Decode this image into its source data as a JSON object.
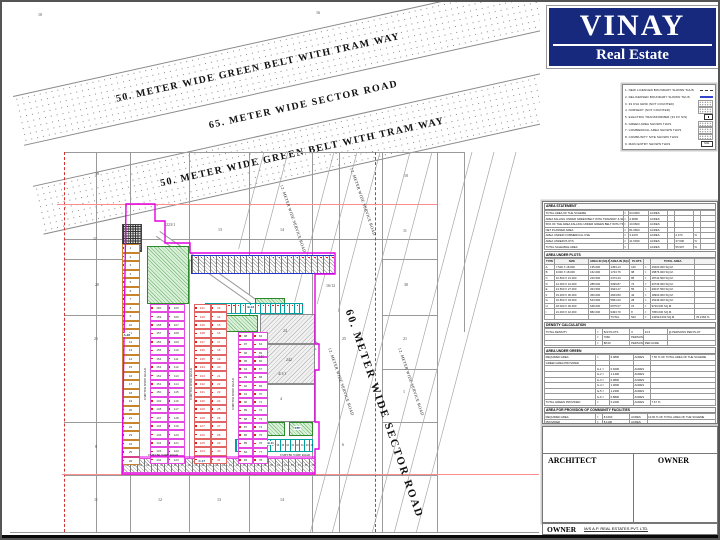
{
  "logo": {
    "title": "VINAY",
    "subtitle": "Real Estate",
    "bg": "#16297c"
  },
  "legend": {
    "items": [
      {
        "n": "1.",
        "label": "NEW LICENCED BOUNDARY SHOWN THUS",
        "sym": "dashdot"
      },
      {
        "n": "2.",
        "label": "DELICENSED BOUNDARY SHOWN THUS",
        "sym": "blue"
      },
      {
        "n": "3.",
        "label": "33 KVA GRID (NOT COUNTED)",
        "sym": "dots"
      },
      {
        "n": "4.",
        "label": "NURSERY (NOT COUNTED)",
        "sym": "dots"
      },
      {
        "n": "5.",
        "label": "ELECTRIC TRANSFORMER (33 KV S/S)",
        "sym": "box"
      },
      {
        "n": "6.",
        "label": "GREEN AREA SHOWN THUS",
        "sym": "dots"
      },
      {
        "n": "7.",
        "label": "COMMERCIAL AREA SHOWN THUS",
        "sym": "dots"
      },
      {
        "n": "8.",
        "label": "COMMUNITY SITE SHOWN THUS",
        "sym": "dots"
      },
      {
        "n": "9.",
        "label": "MAIN ENTRY SHOWN THUS",
        "sym": "me",
        "sym_text": "M.E."
      }
    ]
  },
  "tables": [
    {
      "title": "AREA STATEMENT",
      "widths": [
        46,
        3,
        12,
        11,
        4,
        11,
        4,
        9
      ],
      "rows": [
        [
          "TOTAL AREA OF THE SCHEME",
          "=",
          "94.0000",
          "ACRES",
          "",
          "",
          "",
          ""
        ],
        [
          "AREA FALLING UNDER GREEN BELT WITH TRAMWAY & SECTOR ROAD",
          "=",
          "4.3800",
          "ACRES",
          "",
          "",
          "",
          ""
        ],
        [
          "50% OF THE AREA FALLING UNDER GREEN BELT WITH TRAM WAY",
          "=",
          "10.0600",
          "ACRES",
          "",
          "",
          "",
          ""
        ],
        [
          "NET PLANNED AREA",
          "=",
          "81.0600",
          "ACRES",
          "",
          "",
          "",
          ""
        ],
        [
          "AREA UNDER COMMERCIAL USE",
          "=",
          "3.2470",
          "ACRES",
          "",
          "2.470",
          "%",
          ""
        ],
        [
          "AREA UNDER PLOTS",
          "=",
          "41.5030",
          "ACRES",
          "",
          "37.600",
          "%",
          ""
        ],
        [
          "TOTAL SALEABLE AREA",
          "=",
          "",
          "ACRES",
          "",
          "55.907",
          "%",
          ""
        ]
      ]
    },
    {
      "title": "AREA UNDER PLOTS",
      "headers": [
        "TYPE",
        "SIZE",
        "AREA IN (SQ.M.)",
        "AREA IN (SQ.FT.)",
        "PLOTS",
        "",
        "TOTAL AREA",
        ""
      ],
      "widths": [
        6,
        20,
        12,
        12,
        8,
        4,
        26,
        12
      ],
      "rows": [
        [
          "A",
          "7.500 X 18.000",
          "135.000",
          "1453.14",
          "120",
          "=",
          "16200.000  SQ.M.",
          ""
        ],
        [
          "B",
          "9.000 X 18.000",
          "162.000",
          "1743.76",
          "98",
          "=",
          "15876.000  SQ.M.",
          ""
        ],
        [
          "C",
          "10.500 X 21.000",
          "220.500",
          "2373.43",
          "85",
          "=",
          "18742.500  SQ.M.",
          ""
        ],
        [
          "D",
          "12.000 X 24.000",
          "288.000",
          "3099.87",
          "72",
          "=",
          "20736.000  SQ.M.",
          ""
        ],
        [
          "E",
          "13.500 X 27.000",
          "364.500",
          "3923.27",
          "55",
          "=",
          "20047.500  SQ.M.",
          ""
        ],
        [
          "F",
          "15.000 X 30.000",
          "450.000",
          "4843.80",
          "42",
          "=",
          "18900.000  SQ.M.",
          ""
        ],
        [
          "G",
          "16.500 X 33.000",
          "544.500",
          "5861.00",
          "28",
          "=",
          "15246.000  SQ.M.",
          ""
        ],
        [
          "H",
          "18.000 X 36.000",
          "648.000",
          "6975.07",
          "15",
          "=",
          "9720.000  SQ.M.",
          ""
        ],
        [
          "I",
          "21.000 X 42.000",
          "882.000",
          "9493.70",
          "8",
          "=",
          "7056.000  SQ.M.",
          ""
        ],
        [
          "",
          "",
          "",
          "TOTAL",
          "523",
          "=",
          "142524.000  SQ.M.",
          "35.2184 %"
        ]
      ]
    },
    {
      "title": "DENSITY CALCULATION",
      "widths": [
        30,
        4,
        16,
        8,
        14,
        28
      ],
      "rows": [
        [
          "TOTAL DENSITY",
          "=",
          "523 PLOTS",
          "X",
          "13.5",
          "@ PERSONS PER PLOT"
        ],
        [
          "",
          "=",
          "7060",
          "PERSONS",
          "",
          ""
        ],
        [
          "",
          "=",
          "88.00",
          "PERSONS",
          "PER ACRE",
          ""
        ]
      ]
    },
    {
      "title": "AREA UNDER GREEN",
      "widths": [
        30,
        8,
        14,
        10,
        38
      ],
      "rows": [
        [
          "REQUIRED AREA",
          "=",
          "6.0800",
          "ACRES",
          "7.50 % OF TOTAL AREA OF THE SCHEME"
        ],
        [
          "GREEN AREA PROVIDED",
          "",
          "",
          "",
          ""
        ],
        [
          "",
          "G-1  =",
          "0.9200",
          "ACRES",
          ""
        ],
        [
          "",
          "G-2  =",
          "1.1400",
          "ACRES",
          ""
        ],
        [
          "",
          "G-3  =",
          "0.9800",
          "ACRES",
          ""
        ],
        [
          "",
          "G-4  =",
          "1.0600",
          "ACRES",
          ""
        ],
        [
          "",
          "G-5  =",
          "1.2400",
          "ACRES",
          ""
        ],
        [
          "",
          "G-6  =",
          "0.8800",
          "ACRES",
          ""
        ],
        [
          "TOTAL GREEN PROVIDED",
          "=",
          "6.2200",
          "ACRES",
          "7.67 %"
        ]
      ]
    },
    {
      "title": "AREA FOR PROVISION OF COMMUNITY FACILITIES",
      "widths": [
        30,
        4,
        16,
        10,
        40
      ],
      "rows": [
        [
          "REQUIRED AREA",
          "=",
          "8.1060",
          "ACRES",
          "10.00 % OF TOTAL AREA OF THE SCHEME"
        ],
        [
          "PROVIDED",
          "=",
          "8.1100",
          "ACRES",
          ""
        ]
      ]
    },
    {
      "title": "AREA FOR PROVISION OF SERVICES",
      "widths": [
        44,
        4,
        16,
        12,
        24
      ],
      "rows": [
        [
          "HIGH TENSION LINE CORRIDOR",
          "=",
          "1520.00",
          "SQ.MT.",
          ""
        ],
        [
          "ELECTRIC TRANSFORMER (33 KV S/S)",
          "=",
          "900.00",
          "SQ.MT.",
          ""
        ],
        [
          "WATER WORKS / BOOSTING STATION",
          "=",
          "2025.00",
          "SQ.MT.",
          ""
        ],
        [
          "SEWAGE TREATMENT PLANT",
          "=",
          "1800.00",
          "SQ.MT.",
          ""
        ]
      ]
    },
    {
      "title": "FRINGE PLOTS",
      "subtitle": "AREA UNDER PLOTS",
      "headers": [
        "TYPE",
        "SIZE",
        "AREA IN (SQ.M.)",
        "AREA IN (SQ.FT.)",
        "PLOTS",
        "",
        "TOTAL AREA",
        ""
      ],
      "widths": [
        6,
        20,
        12,
        14,
        10,
        4,
        22,
        12
      ],
      "rows": [
        [
          "A",
          "7.500 X 16.500",
          "123.750",
          "1332.06",
          "26",
          "=",
          "3217.500  SQ.M.",
          ""
        ],
        [
          "B",
          "9.000 X 16.500",
          "148.500",
          "1598.47",
          "20",
          "=",
          "2970.000  SQ.M.",
          ""
        ],
        [
          "C",
          "10.500 X 19.500",
          "204.750",
          "2203.89",
          "14",
          "=",
          "2866.500  SQ.M.",
          ""
        ],
        [
          "D",
          "12.000 X 22.500",
          "270.000",
          "2906.28",
          "9",
          "=",
          "2430.000  SQ.M.",
          ""
        ],
        [
          "E",
          "15.000 X 27.000",
          "405.000",
          "4359.42",
          "5",
          "=",
          "2025.000  SQ.M.",
          "13.2840 %"
        ],
        [
          "",
          "",
          "",
          "FRONT SET BACK",
          "3.00 MTS.",
          "",
          "",
          ""
        ],
        [
          "",
          "",
          "",
          "REAR SET BACK",
          "4.50 MTS.",
          "",
          "",
          ""
        ]
      ]
    }
  ],
  "notes": [
    "OWNER SHIP DETAIL : LAND OWNED VIDE SALE DEED NO. - 2016",
    "ALL DIMENSIONS ARE IN METERS UNLESS OTHERWISE SPECIFIED",
    "THIS DRAWING IS TO BE READ WITH THE LICENCE GRANTED"
  ],
  "titleblock": {
    "architect_label": "ARCHITECT",
    "owner_label": "OWNER",
    "owner_strip_label": "OWNER",
    "owner_name": "M/S A.P. REAL ESTATES PVT. LTD."
  },
  "plan": {
    "corner_numbers": [
      {
        "t": "10",
        "x": 36,
        "y": 10
      },
      {
        "t": "16",
        "x": 314,
        "y": 8
      }
    ],
    "bands": [
      {
        "label": "50. METER WIDE GREEN BELT WITH TRAM WAY",
        "dotted": true,
        "h": 50,
        "pad": 100
      },
      {
        "label": "65. METER WIDE SECTOR ROAD",
        "dotted": false,
        "h": 42,
        "pad": 185
      },
      {
        "label": "50. METER WIDE GREEN BELT WITH TRAM WAY",
        "dotted": true,
        "h": 50,
        "pad": 125
      }
    ],
    "sector_road": {
      "label": "60. METER WIDE SECTOR ROAD",
      "x": 352,
      "y": 306,
      "rot": 71
    },
    "service_road_label": "12. METER WIDE SERVICE ROAD",
    "service_roads": [
      {
        "x": 282,
        "y": 182
      },
      {
        "x": 352,
        "y": 165
      },
      {
        "x": 330,
        "y": 345
      },
      {
        "x": 400,
        "y": 345
      }
    ],
    "inner_road_label": "9 METER WIDE ROAD",
    "inner_roads_v": [
      {
        "x": 141,
        "y": 380
      },
      {
        "x": 187,
        "y": 380
      },
      {
        "x": 229,
        "y": 390
      }
    ],
    "inner_roads_h": [
      {
        "x": 146,
        "y": 451
      },
      {
        "x": 278,
        "y": 451
      }
    ],
    "khasra_numbers": [
      {
        "t": "18",
        "x": 93,
        "y": 169
      },
      {
        "t": "10",
        "x": 402,
        "y": 171
      },
      {
        "t": "1223/1",
        "x": 162,
        "y": 220
      },
      {
        "t": "13",
        "x": 216,
        "y": 225
      },
      {
        "t": "14",
        "x": 278,
        "y": 225
      },
      {
        "t": "11",
        "x": 401,
        "y": 226
      },
      {
        "t": "11",
        "x": 91,
        "y": 234
      },
      {
        "t": "20",
        "x": 93,
        "y": 280
      },
      {
        "t": "30",
        "x": 402,
        "y": 280
      },
      {
        "t": "16/12",
        "x": 324,
        "y": 281
      },
      {
        "t": "21",
        "x": 92,
        "y": 334
      },
      {
        "t": "21",
        "x": 401,
        "y": 334
      },
      {
        "t": "25",
        "x": 340,
        "y": 334
      },
      {
        "t": "1",
        "x": 401,
        "y": 387
      },
      {
        "t": "6",
        "x": 340,
        "y": 440
      },
      {
        "t": "8",
        "x": 93,
        "y": 442
      },
      {
        "t": "24",
        "x": 281,
        "y": 326
      },
      {
        "t": "241",
        "x": 256,
        "y": 352
      },
      {
        "t": "242",
        "x": 284,
        "y": 355
      },
      {
        "t": "4/1/1",
        "x": 276,
        "y": 369
      },
      {
        "t": "4",
        "x": 278,
        "y": 394
      },
      {
        "t": "11",
        "x": 92,
        "y": 495
      },
      {
        "t": "12",
        "x": 156,
        "y": 495
      },
      {
        "t": "13",
        "x": 215,
        "y": 495
      },
      {
        "t": "14",
        "x": 278,
        "y": 495
      }
    ],
    "colony_labels": [
      {
        "t": "C-17",
        "x": 196,
        "y": 457
      },
      {
        "t": "B-11",
        "x": 265,
        "y": 439
      },
      {
        "t": "B-13",
        "x": 245,
        "y": 303
      },
      {
        "t": "STP",
        "x": 292,
        "y": 424
      },
      {
        "t": "A-28",
        "x": 121,
        "y": 331
      }
    ],
    "plot_columns": [
      {
        "x": 119.5,
        "y": 242,
        "w": 18,
        "rows": 26,
        "rowH": 8.5,
        "sub": 1,
        "border": "#c8842c",
        "numColor": "#333",
        "seq": [
          [
            1,
            1
          ]
        ]
      },
      {
        "x": 148,
        "y": 302,
        "w": 35,
        "rows": 19,
        "rowH": 8.42,
        "sub": 2,
        "border": "#e24ae2",
        "numColor": "#333",
        "seq": [
          [
            160,
            -1
          ],
          [
            105,
            1
          ]
        ]
      },
      {
        "x": 192,
        "y": 302,
        "w": 33,
        "rows": 19,
        "rowH": 8.42,
        "sub": 2,
        "border": "#e06666",
        "numColor": "#c22",
        "seq": [
          [
            141,
            -1
          ],
          [
            13,
            1
          ]
        ]
      },
      {
        "x": 236,
        "y": 330,
        "w": 30,
        "rows": 16,
        "rowH": 8.25,
        "sub": 2,
        "border": "#e24ae2",
        "numColor": "#333",
        "seq": [
          [
            98,
            -1
          ],
          [
            63,
            1
          ]
        ]
      }
    ],
    "strips": [
      {
        "kind": "hatch",
        "x": 189,
        "y": 253,
        "w": 143,
        "h": 19,
        "cells": 24,
        "border": "#2233cc",
        "bw": 1.2
      },
      {
        "kind": "cyan",
        "x": 203,
        "y": 301,
        "w": 98,
        "h": 11,
        "cells": 20,
        "border": "#00a0a0"
      },
      {
        "kind": "cyan",
        "x": 233,
        "y": 437,
        "w": 78,
        "h": 13,
        "cells": 16,
        "border": "#00a0a0",
        "numStart": 44,
        "numDir": -1
      },
      {
        "kind": "hatch",
        "x": 120,
        "y": 456,
        "w": 193,
        "h": 15,
        "cells": 28,
        "border": "#e24ae2",
        "bw": 1,
        "numStart": 29,
        "numDir": 1
      }
    ],
    "greens": [
      [
        145,
        244,
        42,
        58
      ],
      [
        210,
        313,
        46,
        17
      ],
      [
        253,
        296,
        30,
        12
      ],
      [
        255,
        420,
        28,
        14
      ],
      [
        287,
        420,
        24,
        14
      ]
    ],
    "grays": [
      [
        258,
        312,
        55,
        30
      ],
      [
        245,
        342,
        68,
        40
      ]
    ],
    "white_regions": [
      [
        250,
        382,
        63,
        38
      ]
    ],
    "dark_block": [
      120,
      222,
      20,
      28
    ],
    "boundary_path": "M124,202 L153,202 L153,219 L163,219 L163,241 L188,241 L188,251 L333,251 L333,272 L313,272 L313,342 L317,342 L317,368 L313,368 L313,420 L317,420 L317,447 L313,447 L313,472 L120,472 Z",
    "boundary_extra": "M120,455 L313,455",
    "grid_v": [
      {
        "x": 94,
        "y1": 150,
        "y2": 530
      },
      {
        "x": 128,
        "y1": 150,
        "y2": 530
      },
      {
        "x": 187,
        "y1": 150,
        "y2": 530
      },
      {
        "x": 247,
        "y1": 150,
        "y2": 530
      },
      {
        "x": 310,
        "y1": 150,
        "y2": 530
      },
      {
        "x": 337,
        "y1": 150,
        "y2": 530
      },
      {
        "x": 380,
        "y1": 150,
        "y2": 530
      },
      {
        "x": 435,
        "y1": 150,
        "y2": 530
      },
      {
        "x": 462,
        "y1": 150,
        "y2": 330
      }
    ],
    "grid_h": [
      {
        "y": 150,
        "x1": 62,
        "x2": 462
      },
      {
        "y": 237,
        "x1": 62,
        "x2": 435
      },
      {
        "y": 257,
        "x1": 62,
        "x2": 128
      },
      {
        "y": 257,
        "x1": 380,
        "x2": 435
      },
      {
        "y": 313,
        "x1": 62,
        "x2": 128
      },
      {
        "y": 313,
        "x1": 380,
        "x2": 435
      },
      {
        "y": 367,
        "x1": 380,
        "x2": 435
      },
      {
        "y": 420,
        "x1": 62,
        "x2": 128
      },
      {
        "y": 420,
        "x1": 380,
        "x2": 435
      },
      {
        "y": 473,
        "x1": 62,
        "x2": 435
      },
      {
        "y": 530,
        "x1": 8,
        "x2": 537
      }
    ],
    "red_dashed_v": [
      {
        "x": 62,
        "y1": 150,
        "y2": 530
      },
      {
        "x": 373,
        "y1": 150,
        "y2": 530
      }
    ],
    "pink_h": [
      {
        "y": 202,
        "x1": 55,
        "x2": 435
      },
      {
        "y": 472,
        "x1": 60,
        "x2": 537
      }
    ],
    "diagonals": [
      {
        "t": 262,
        "y2": 247
      },
      {
        "t": 286,
        "y2": 252
      },
      {
        "t": 332,
        "y2": 300
      },
      {
        "t": 355,
        "y2": 302
      },
      {
        "t": 378,
        "y2": 310
      },
      {
        "t": 408,
        "y2": 530
      },
      {
        "t": 430,
        "y2": 530
      },
      {
        "t": 470,
        "y2": 530
      },
      {
        "t": 492,
        "y2": 530
      },
      {
        "t": 514,
        "y2": 530
      }
    ],
    "entry_road": {
      "x": 158,
      "y": 229,
      "len": 196,
      "rot": 35.3
    }
  },
  "colors": {
    "navy": "#16297c",
    "magenta": "#e400e4",
    "red": "#d23333",
    "pink": "#ff8c8c",
    "grid": "#9a9a9a",
    "blue": "#2233cc",
    "cyan": "#00a0a0",
    "tan": "#c8842c",
    "green": "#2a8a2a"
  }
}
